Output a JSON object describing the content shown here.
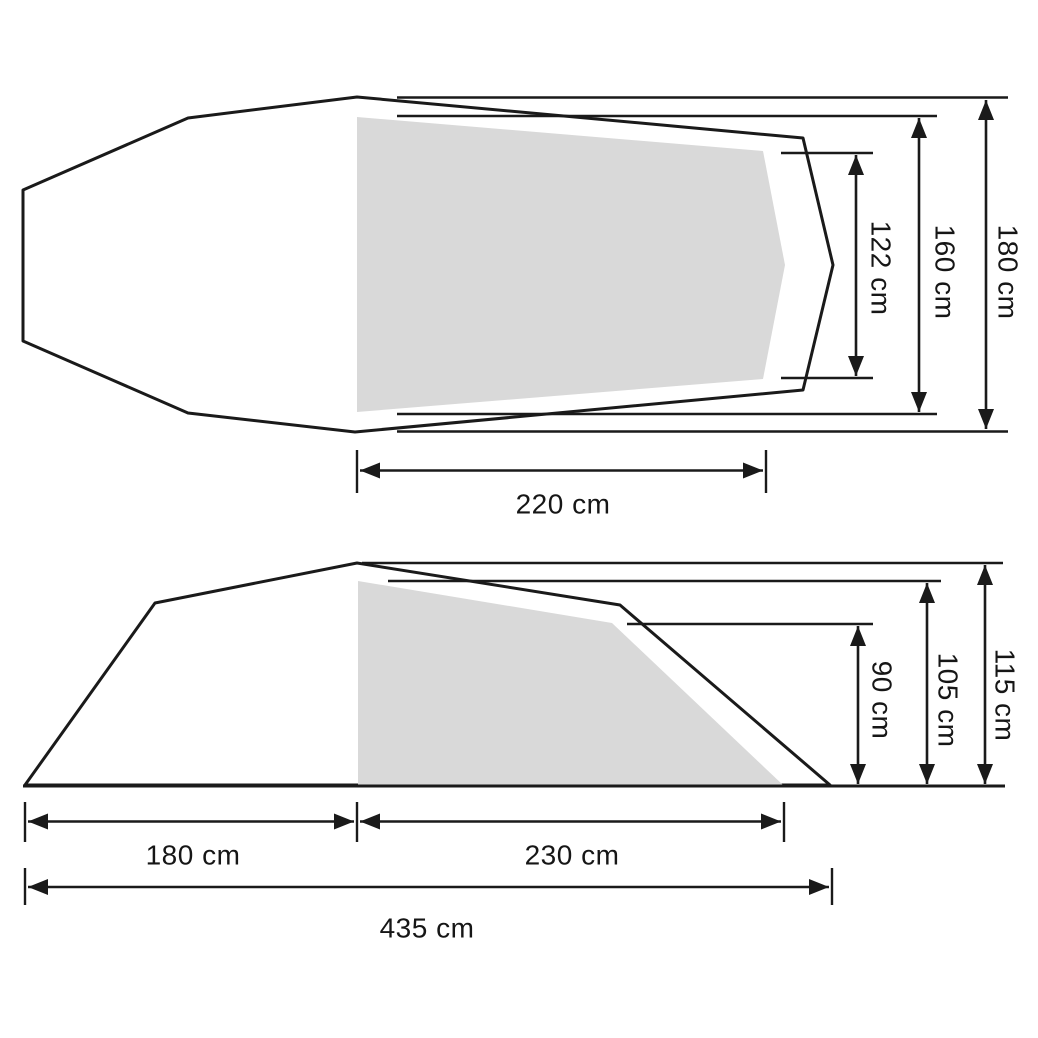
{
  "views": {
    "top": {
      "name": "tent top view",
      "dimensions": {
        "inner_rear_width": "122 cm",
        "inner_front_width": "160 cm",
        "outer_max_width": "180 cm",
        "inner_length": "220 cm"
      }
    },
    "side": {
      "name": "tent side view",
      "dimensions": {
        "inner_rear_height": "90 cm",
        "inner_front_height": "105 cm",
        "outer_peak_height": "115 cm",
        "vestibule_length": "180 cm",
        "inner_length": "230 cm",
        "total_length": "435 cm"
      }
    }
  },
  "colors": {
    "line": "#1a1a1a",
    "inner_tent_fill": "#d9d9d9",
    "background": "#ffffff"
  }
}
